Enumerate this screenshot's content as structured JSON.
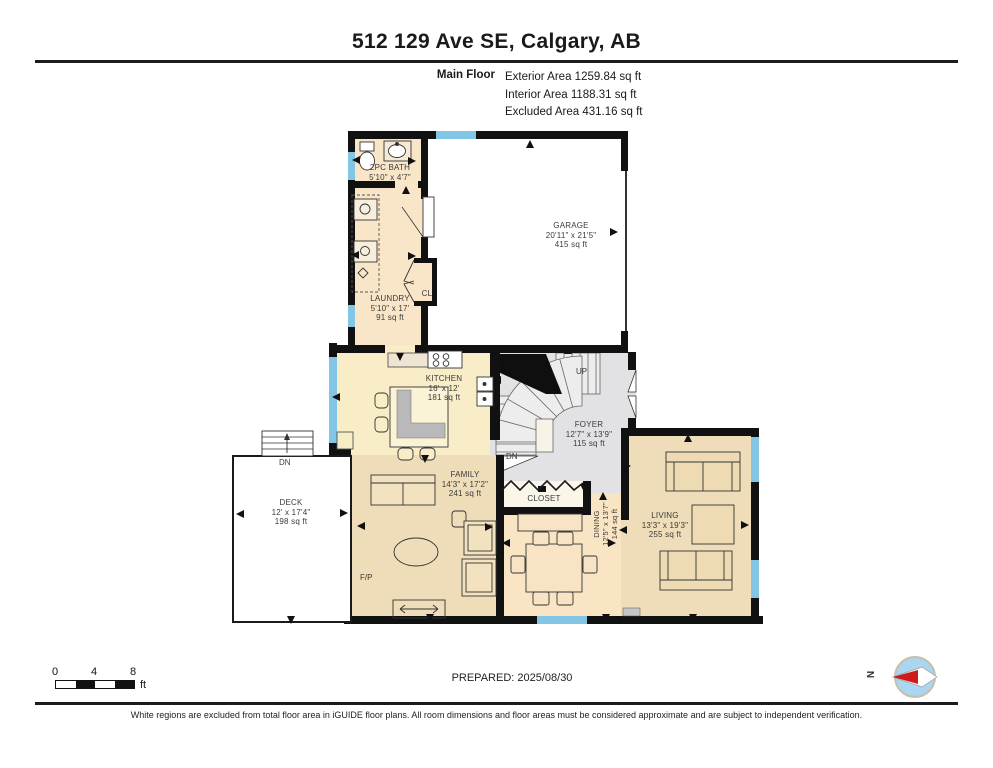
{
  "header": {
    "title": "512 129 Ave SE, Calgary, AB",
    "floor_label": "Main Floor",
    "areas": {
      "exterior": "Exterior Area 1259.84 sq ft",
      "interior": "Interior Area 1188.31 sq ft",
      "excluded": "Excluded Area 431.16 sq ft"
    }
  },
  "rooms": {
    "bath": {
      "name": "2PC BATH",
      "dims": "5'10\" x 4'7\""
    },
    "garage": {
      "name": "GARAGE",
      "dims": "20'11\" x 21'5\"",
      "area": "415 sq ft"
    },
    "laundry": {
      "name": "LAUNDRY",
      "dims": "5'10\" x 17'",
      "area": "91 sq ft"
    },
    "cl": {
      "name": "CL"
    },
    "kitchen": {
      "name": "KITCHEN",
      "dims": "16' x 12'",
      "area": "181 sq ft"
    },
    "foyer": {
      "name": "FOYER",
      "dims": "12'7\" x 13'9\"",
      "area": "115 sq ft"
    },
    "deck": {
      "name": "DECK",
      "dims": "12' x 17'4\"",
      "area": "198 sq ft"
    },
    "family": {
      "name": "FAMILY",
      "dims": "14'3\" x 17'2\"",
      "area": "241 sq ft"
    },
    "closet": {
      "name": "CLOSET"
    },
    "dining": {
      "name": "DINING",
      "dims": "12'5\" x 13'7\"",
      "area": "144 sq ft"
    },
    "living": {
      "name": "LIVING",
      "dims": "13'3\" x 19'3\"",
      "area": "255 sq ft"
    },
    "fireplace_label": "F/P",
    "stairs_up_label": "UP",
    "stairs_down_label": "DN",
    "deck_stairs_down_label": "DN"
  },
  "footer": {
    "scale": {
      "tick0": "0",
      "tick1": "4",
      "tick2": "8",
      "unit": "ft"
    },
    "prepared": "PREPARED: 2025/08/30",
    "compass_label": "N",
    "disclaimer": "White regions are excluded from total floor area in iGUIDE floor plans. All room dimensions and floor areas must be considered approximate and are subject to independent verification."
  },
  "colors": {
    "wall": "#111111",
    "window": "#82c5e5",
    "room_peach": "#f9e6c9",
    "room_cream": "#f8edc7",
    "room_tan": "#eeddb8",
    "foyer_gray": "#e2e2e4",
    "compass_blue": "#a9d6f1",
    "compass_red": "#cf1b1b"
  }
}
